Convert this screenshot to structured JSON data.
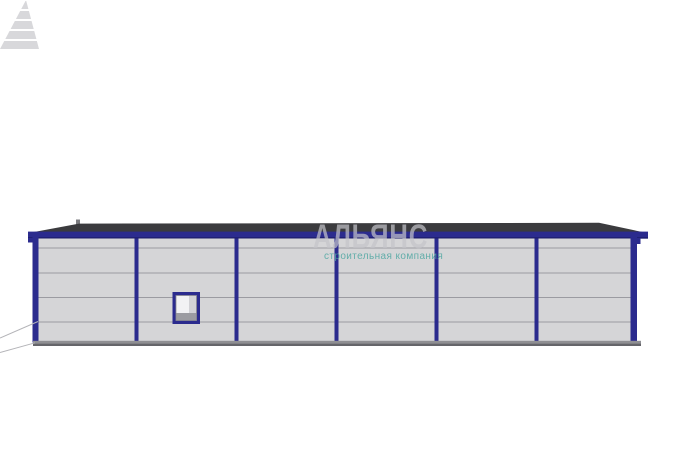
{
  "scene": {
    "type": "3d-building-elevation-render",
    "background_color": "#ffffff",
    "building": {
      "bays": 6,
      "panel_seam_rows": 4,
      "colors": {
        "wall": "#d5d5d7",
        "frame": "#2b2b8e",
        "frame_dark": "#1e1e6e",
        "roof": "#3b3b3e",
        "seam": "#9b9ba1",
        "base": "#8f8f93",
        "base_shadow": "#65656a",
        "guide_line": "#b4b4b8",
        "vent": "#7d7d81"
      },
      "window": {
        "frame": "#2b2b8e",
        "pane": "#f2f2f4",
        "pane_shade": "#d2d2d6",
        "sill": "#9c9ca2",
        "inner_line": "#8c8c92"
      }
    }
  },
  "watermark": {
    "logo_icon": "striped-pyramid-icon",
    "logo_color": "#b9b9bf",
    "title": "АЛЬЯНС",
    "title_color": "#c4c4ca",
    "subtitle": "строительная компания",
    "subtitle_color": "#4fa7a2"
  }
}
